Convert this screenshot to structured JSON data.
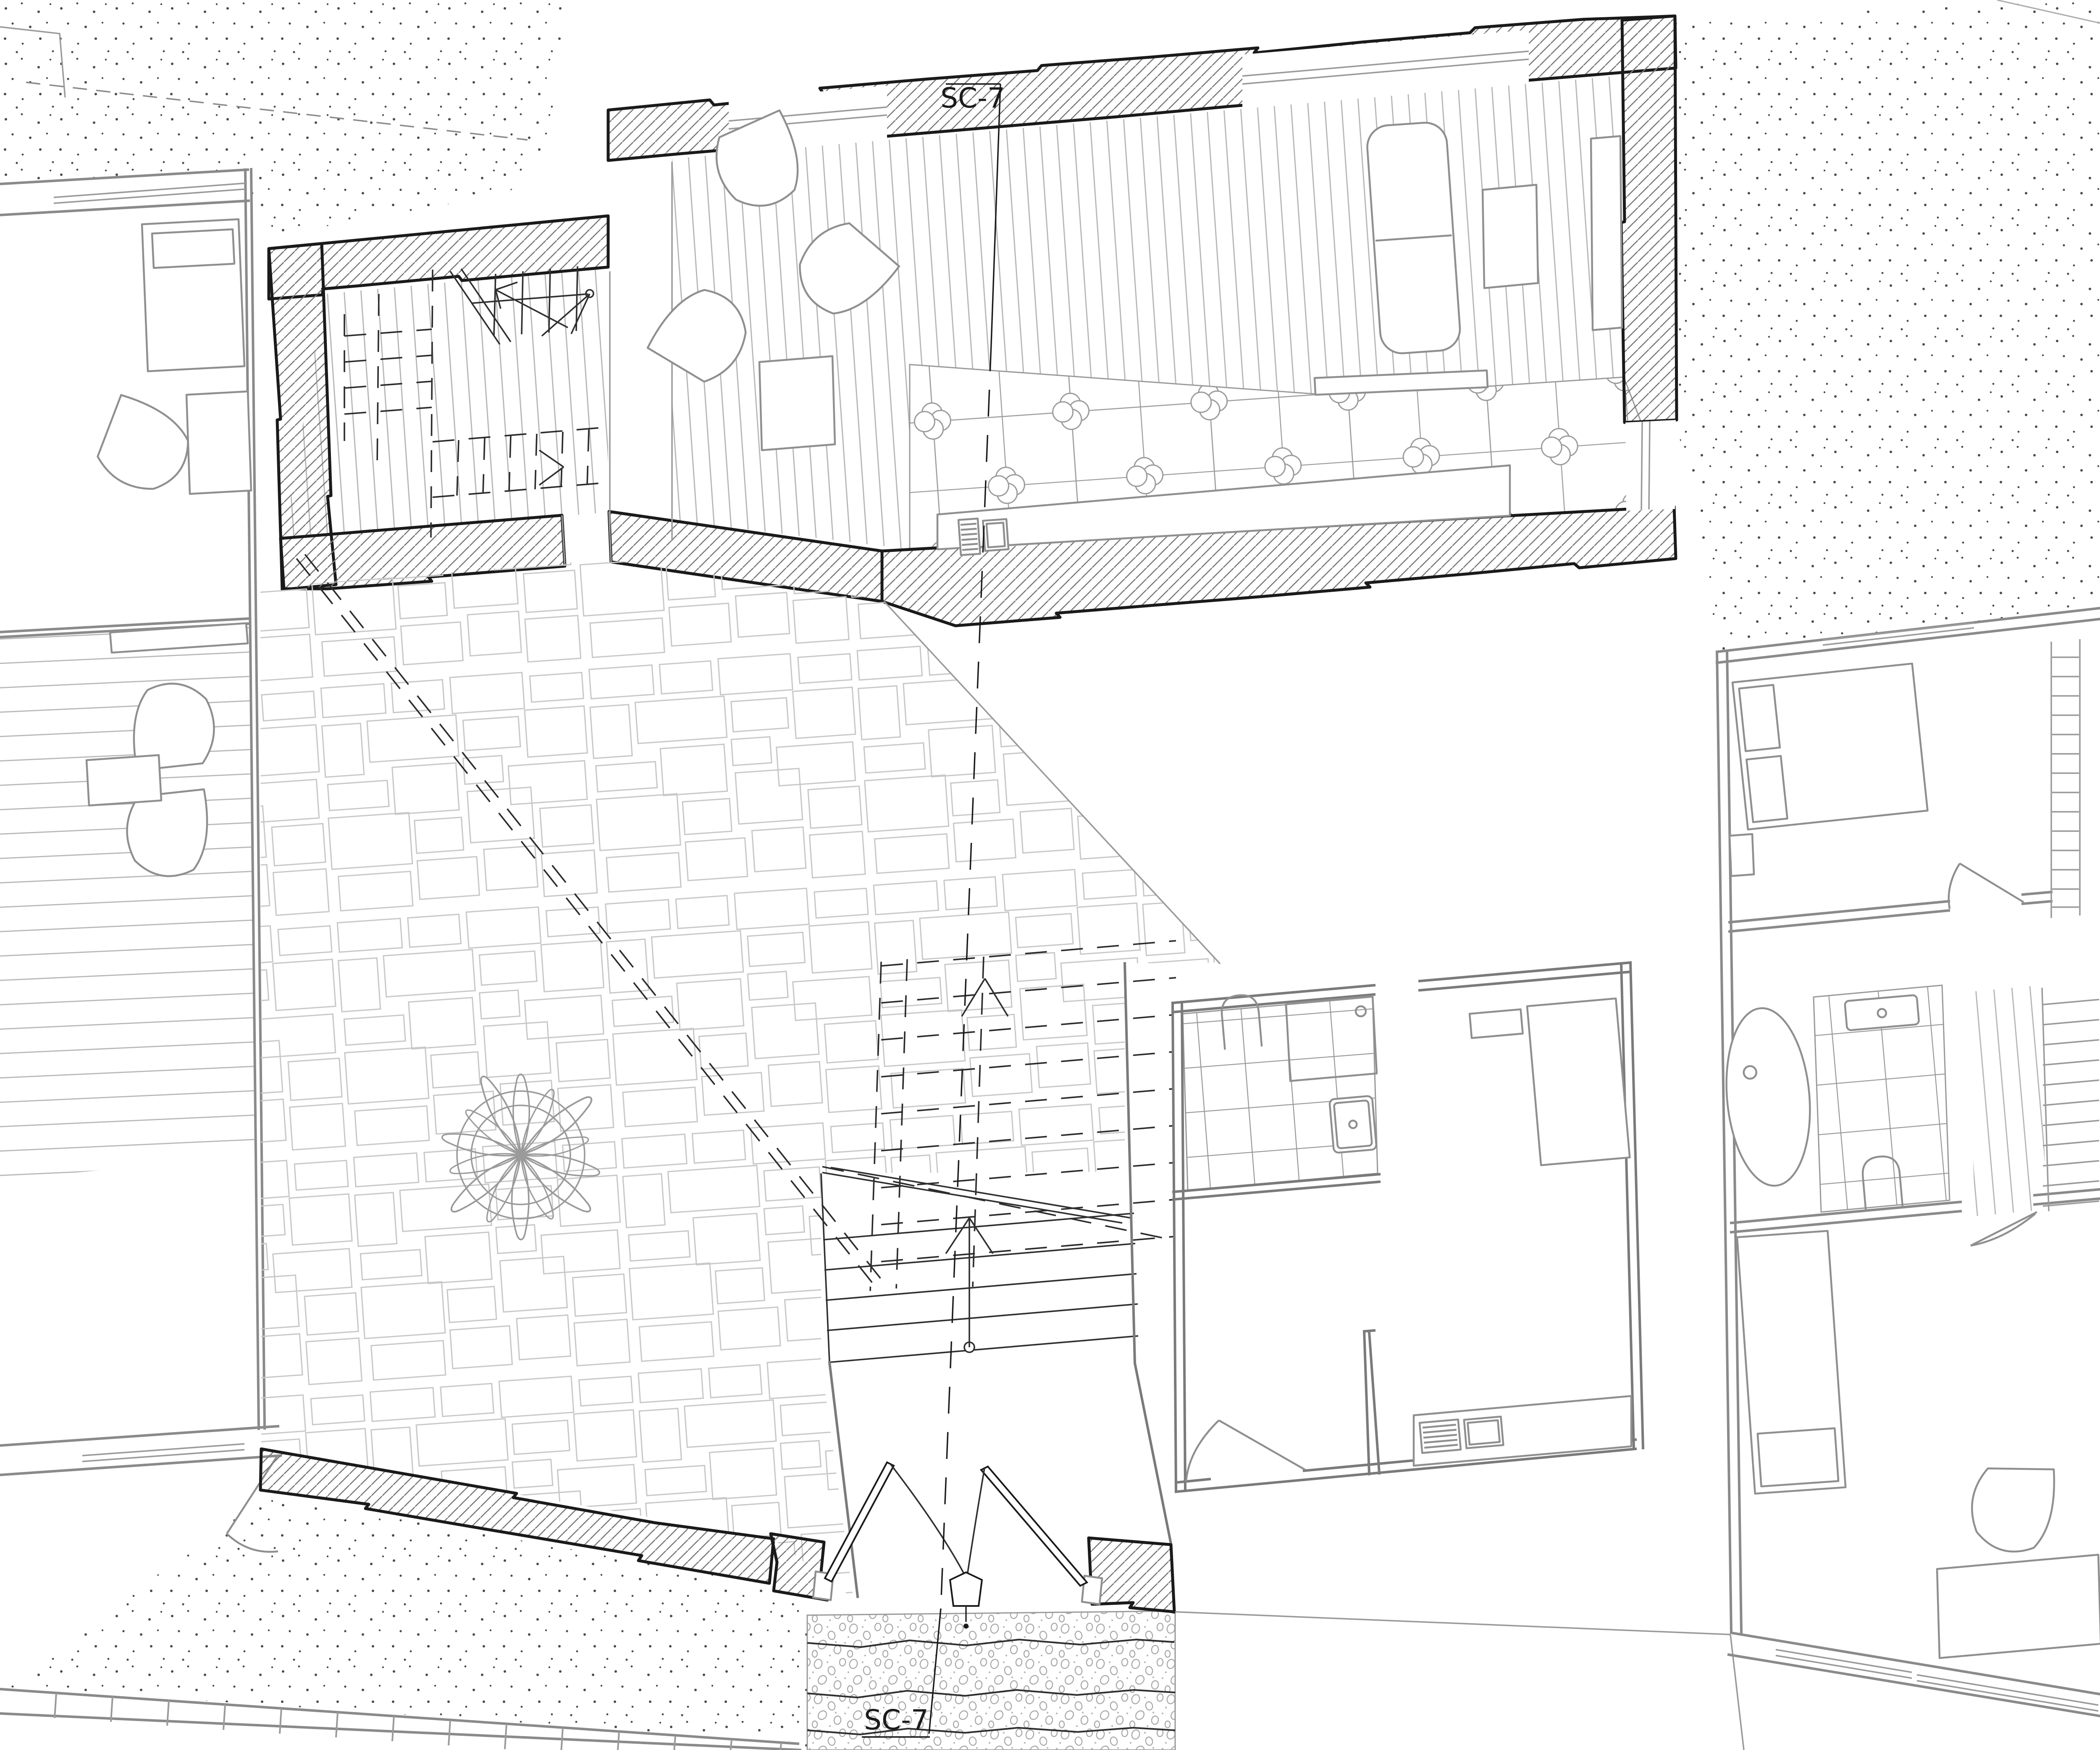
{
  "page": {
    "type": "architectural-floor-plan",
    "background": "#ffffff"
  },
  "section_markers": {
    "top": {
      "label": "SC-7"
    },
    "bottom": {
      "label": "SC-7"
    }
  },
  "palette": {
    "cut_wall_outline": "#1a1a1a",
    "wall_hatch": "#787878",
    "neighbor_walls": "#8a8a8a",
    "furniture": "#8f8f8f",
    "floor_planks": "#b5b5b5",
    "flagstone": "#c8c8c8",
    "tile": "#9a9a9a",
    "stipple_dots": "#4a4a4a",
    "pebbles": "#a8a8a8",
    "dashed_overhead": "#2b2b2b"
  }
}
